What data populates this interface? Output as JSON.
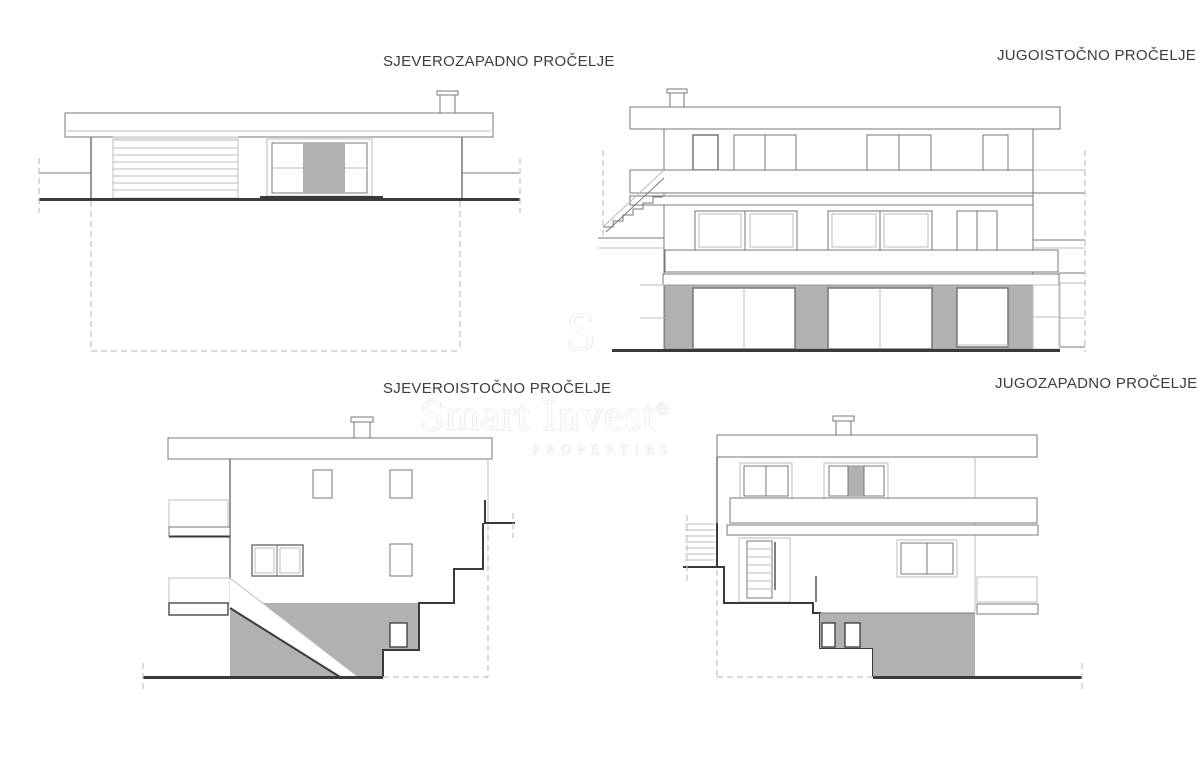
{
  "sheet": {
    "background": "#ffffff",
    "drawing_type": "building elevations"
  },
  "elevations": [
    {
      "id": "northwest",
      "label": "SJEVEROZAPADNO PROČELJE"
    },
    {
      "id": "southeast",
      "label": "JUGOISTOČNO PROČELJE"
    },
    {
      "id": "northeast",
      "label": "SJEVEROISTOČNO PROČELJE"
    },
    {
      "id": "southwest",
      "label": "JUGOZAPADNO PROČELJE"
    }
  ],
  "watermark": {
    "monogram": "S",
    "brand": "Smart Invest",
    "registered_mark": "®",
    "subtitle": "PROPERTIES"
  },
  "colors": {
    "line_dark": "#3a3a3a",
    "line_med": "#777777",
    "line_light": "#bcbcbc",
    "line_dash": "#c2c2c2",
    "fill_gray": "#b1b1b1",
    "label_text": "#3d3d3d",
    "watermark_gray": "#e9e9e9"
  }
}
